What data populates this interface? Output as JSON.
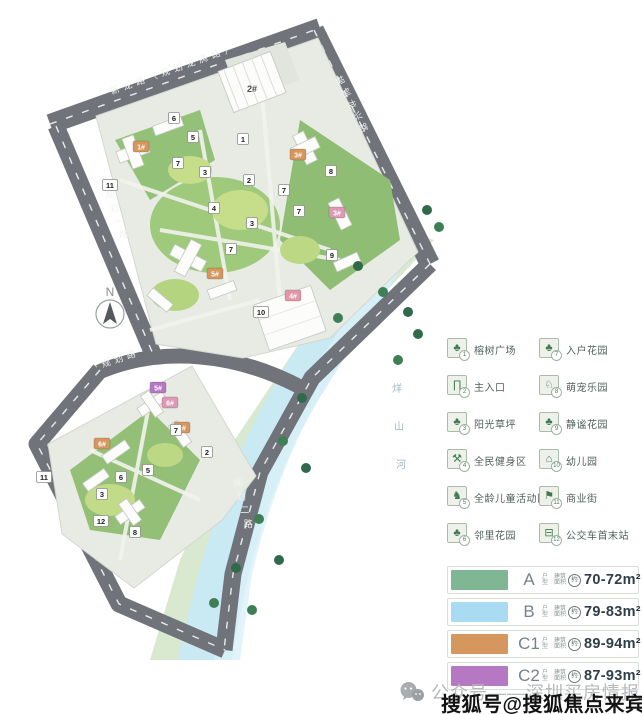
{
  "compass": {
    "label": "N"
  },
  "map": {
    "labels": [
      {
        "kind": "road",
        "name": "新龙路（规划龙腾路）",
        "x": 116,
        "y": 93,
        "dx": 12.6,
        "dy": -4.5,
        "rot": -19.5,
        "size": 9,
        "fill": "#f2f3f1"
      },
      {
        "kind": "road",
        "name": "规划龙兴路",
        "x": 337,
        "y": 82,
        "dx": 5.9,
        "dy": 11.8,
        "rot": 63,
        "size": 9,
        "fill": "#f2f3f1"
      },
      {
        "kind": "road",
        "name": "规划一路",
        "x": 110,
        "y": 198,
        "dx": 4.6,
        "dy": 13.2,
        "rot": 0,
        "size": 9,
        "fill": "#f2f3f1"
      },
      {
        "kind": "road",
        "name": "规划路",
        "x": 107,
        "y": 366,
        "dx": 12.4,
        "dy": -4.2,
        "rot": -18,
        "size": 9,
        "fill": "#f2f3f1"
      },
      {
        "kind": "road",
        "name": "规划二路",
        "x": 238,
        "y": 486,
        "dx": 3.4,
        "dy": 13.6,
        "rot": 0,
        "size": 9,
        "fill": "#f2f3f1"
      },
      {
        "kind": "river",
        "name": "烊山河",
        "x": 397,
        "y": 392,
        "dx": 2,
        "dy": 38,
        "rot": 0,
        "size": 10,
        "fill": "#9fb9c0"
      }
    ],
    "building_labels": [
      {
        "text": "2#",
        "x": 252,
        "y": 92
      }
    ],
    "building_tags": [
      {
        "text": "1#",
        "x": 141,
        "y": 147,
        "color": "#d6975f"
      },
      {
        "text": "3#",
        "x": 298,
        "y": 155,
        "color": "#d6975f"
      },
      {
        "text": "3#",
        "x": 337,
        "y": 213,
        "color": "#dc9ab5"
      },
      {
        "text": "5#",
        "x": 215,
        "y": 274,
        "color": "#d6975f"
      },
      {
        "text": "4#",
        "x": 293,
        "y": 296,
        "color": "#e097a8"
      },
      {
        "text": "5#",
        "x": 158,
        "y": 388,
        "color": "#b678c2"
      },
      {
        "text": "6#",
        "x": 170,
        "y": 403,
        "color": "#dc9ab5"
      },
      {
        "text": "6#",
        "x": 102,
        "y": 444,
        "color": "#d6975f"
      },
      {
        "text": "7#",
        "x": 182,
        "y": 428,
        "color": "#d6975f"
      }
    ],
    "markers": [
      {
        "n": "1",
        "x": 243,
        "y": 139
      },
      {
        "n": "2",
        "x": 249,
        "y": 180
      },
      {
        "n": "3",
        "x": 205,
        "y": 172
      },
      {
        "n": "3",
        "x": 252,
        "y": 223
      },
      {
        "n": "4",
        "x": 214,
        "y": 208
      },
      {
        "n": "5",
        "x": 193,
        "y": 137
      },
      {
        "n": "6",
        "x": 174,
        "y": 118
      },
      {
        "n": "7",
        "x": 178,
        "y": 163
      },
      {
        "n": "7",
        "x": 284,
        "y": 190
      },
      {
        "n": "7",
        "x": 299,
        "y": 211
      },
      {
        "n": "7",
        "x": 231,
        "y": 249
      },
      {
        "n": "8",
        "x": 331,
        "y": 171
      },
      {
        "n": "9",
        "x": 332,
        "y": 255
      },
      {
        "n": "10",
        "x": 261,
        "y": 312
      },
      {
        "n": "11",
        "x": 110,
        "y": 185
      },
      {
        "n": "2",
        "x": 207,
        "y": 452
      },
      {
        "n": "7",
        "x": 176,
        "y": 430
      },
      {
        "n": "5",
        "x": 148,
        "y": 470
      },
      {
        "n": "6",
        "x": 121,
        "y": 477
      },
      {
        "n": "3",
        "x": 102,
        "y": 494
      },
      {
        "n": "12",
        "x": 101,
        "y": 521
      },
      {
        "n": "8",
        "x": 135,
        "y": 532
      },
      {
        "n": "11",
        "x": 44,
        "y": 477
      }
    ]
  },
  "legend_amenities": [
    {
      "num": "1",
      "label": "榕树广场",
      "icon": "tree-icon",
      "glyph": "♣"
    },
    {
      "num": "2",
      "label": "主入口",
      "icon": "gate-icon",
      "glyph": "∏"
    },
    {
      "num": "3",
      "label": "阳光草坪",
      "icon": "lawn-icon",
      "glyph": "♣"
    },
    {
      "num": "4",
      "label": "全民健身区",
      "icon": "fitness-icon",
      "glyph": "⚒"
    },
    {
      "num": "5",
      "label": "全龄儿童活动区",
      "icon": "children-play-icon",
      "glyph": "♞"
    },
    {
      "num": "6",
      "label": "邻里花园",
      "icon": "garden-icon",
      "glyph": "♣"
    },
    {
      "num": "7",
      "label": "入户花园",
      "icon": "entry-garden-icon",
      "glyph": "♣"
    },
    {
      "num": "8",
      "label": "萌宠乐园",
      "icon": "pet-icon",
      "glyph": "♘"
    },
    {
      "num": "9",
      "label": "静谧花园",
      "icon": "quiet-garden-icon",
      "glyph": "♣"
    },
    {
      "num": "10",
      "label": "幼儿园",
      "icon": "kindergarten-icon",
      "glyph": "⌂"
    },
    {
      "num": "11",
      "label": "商业街",
      "icon": "shop-icon",
      "glyph": "⚑"
    },
    {
      "num": "12",
      "label": "公交车首末站",
      "icon": "bus-icon",
      "glyph": "⊟"
    }
  ],
  "unit_legend_labels": {
    "type": "户型",
    "area_prefix": "建筑面积",
    "approx": "约"
  },
  "legend_units": [
    {
      "code": "A",
      "area": "70-72",
      "unit": "m²",
      "color": "#7fb795"
    },
    {
      "code": "B",
      "area": "79-83",
      "unit": "m²",
      "color": "#a9dcf2"
    },
    {
      "code": "C1",
      "area": "89-94",
      "unit": "m²",
      "color": "#d6975f"
    },
    {
      "code": "C2",
      "area": "87-93",
      "unit": "m²",
      "color": "#b678c2"
    }
  ],
  "footer": {
    "text": "公众号——深圳买房情报"
  },
  "watermark": {
    "text": "搜狐号@搜狐焦点来宾站"
  }
}
